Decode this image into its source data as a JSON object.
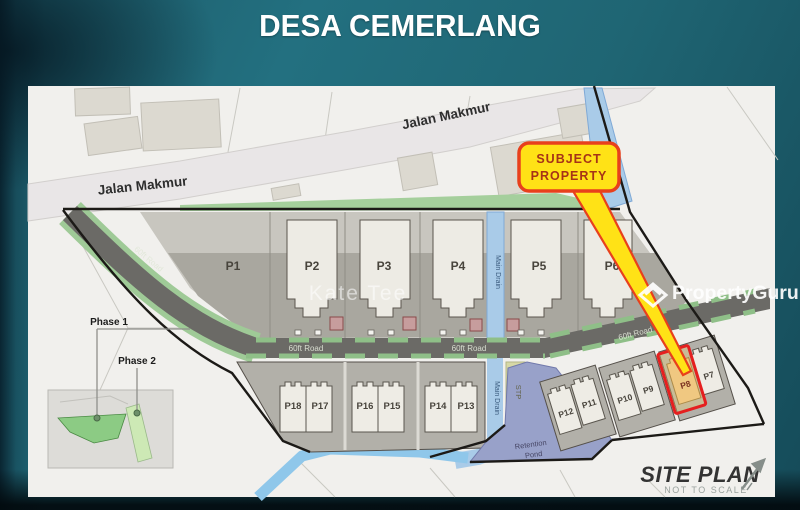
{
  "title": "DESA CEMERLANG",
  "callout": {
    "line1": "SUBJECT",
    "line2": "PROPERTY"
  },
  "watermarks": {
    "agent": "Kate Tee",
    "brand": "PropertyGuru"
  },
  "map": {
    "roads": {
      "jalan_makmur": "Jalan Makmur",
      "road_60ft": "60ft Road"
    },
    "water": {
      "main_drain": "Main Drain",
      "stp": "STP",
      "retention_pond_line1": "Retention",
      "retention_pond_line2": "Pond"
    },
    "phases": {
      "phase1": "Phase 1",
      "phase2": "Phase 2"
    },
    "plots": [
      "P1",
      "P2",
      "P3",
      "P4",
      "P5",
      "P6",
      "P7",
      "P8",
      "P9",
      "P10",
      "P11",
      "P12",
      "P13",
      "P14",
      "P15",
      "P16",
      "P17",
      "P18"
    ],
    "footer": {
      "title": "SITE PLAN",
      "subtitle": "NOT TO SCALE"
    }
  },
  "colors": {
    "background_teal": "#1f6573",
    "map_paper": "#f1f0ed",
    "plot_grey": "#a9a79f",
    "road_dark": "#6b6a66",
    "verge_green": "#9fca97",
    "drain_blue": "#a9cbe8",
    "pond_blue": "#98a1c9",
    "stp_olive": "#d6d8a6",
    "subject_yellow": "#ffe216",
    "subject_red": "#e8401c",
    "highlight_tan": "#eac28a"
  }
}
